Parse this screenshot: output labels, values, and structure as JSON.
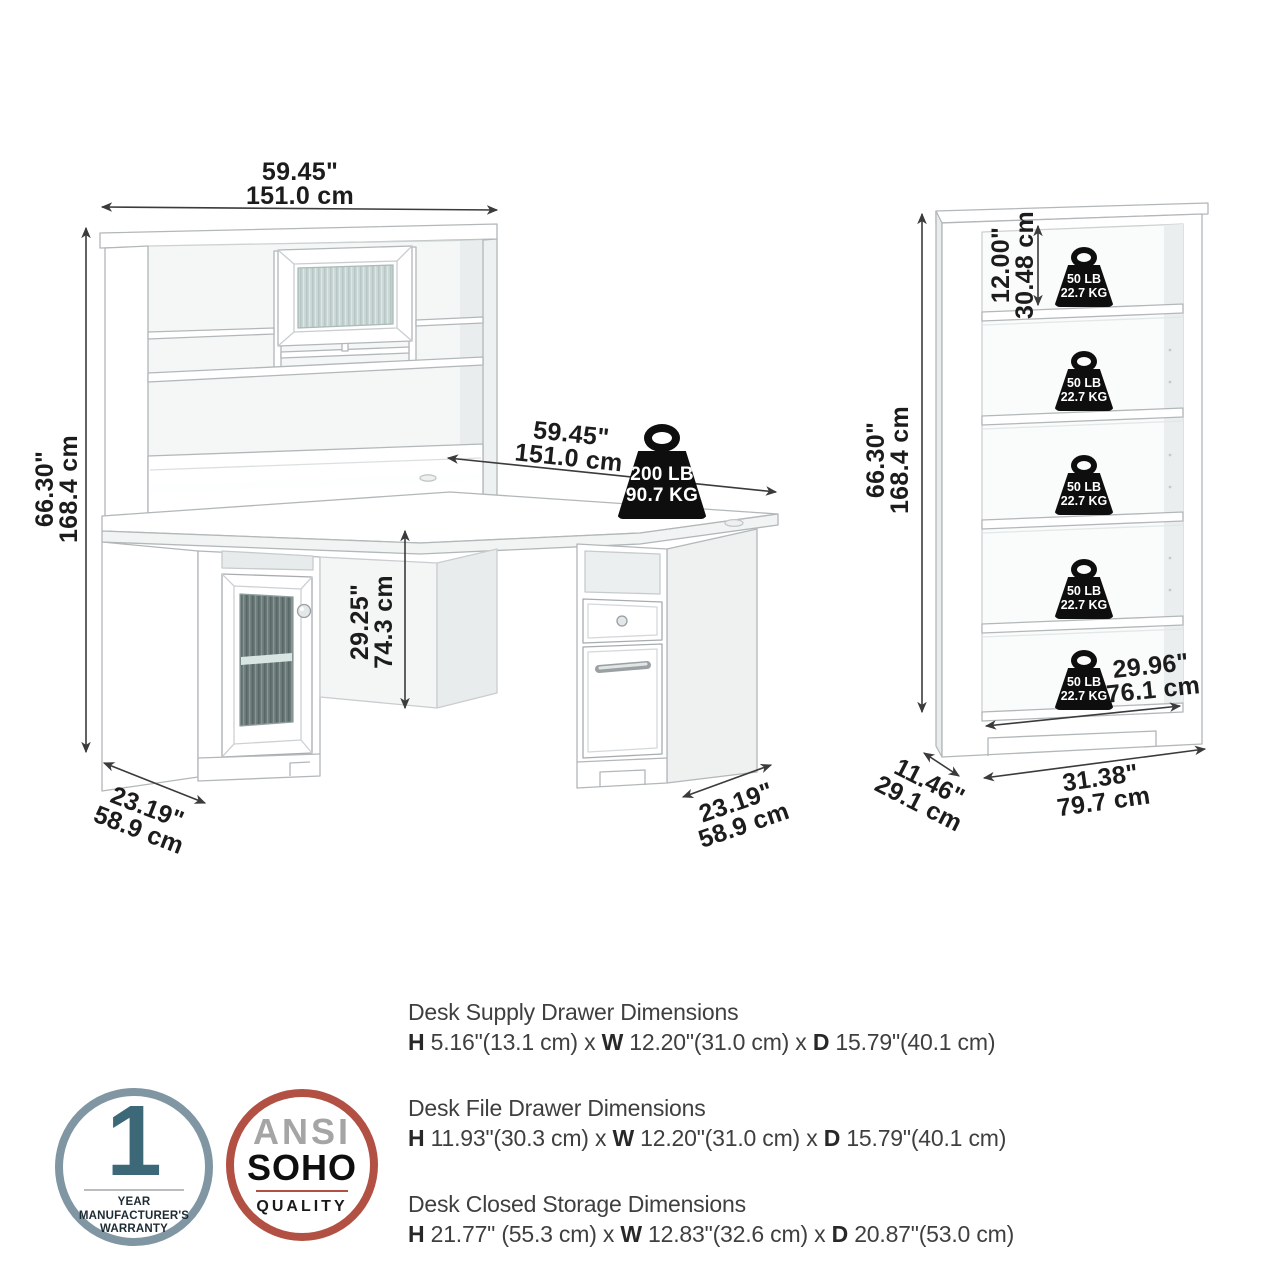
{
  "desk": {
    "hutch_width": {
      "inches": "59.45\"",
      "cm": "151.0 cm"
    },
    "overall_height": {
      "inches": "66.30\"",
      "cm": "168.4 cm"
    },
    "surface_width": {
      "inches": "59.45\"",
      "cm": "151.0 cm"
    },
    "surface_height": {
      "inches": "29.25\"",
      "cm": "74.3 cm"
    },
    "left_depth": {
      "inches": "23.19\"",
      "cm": "58.9 cm"
    },
    "right_depth": {
      "inches": "23.19\"",
      "cm": "58.9 cm"
    },
    "weight_capacity": {
      "lb": "200 LB",
      "kg": "90.7 KG"
    }
  },
  "bookcase": {
    "overall_height": {
      "inches": "66.30\"",
      "cm": "168.4 cm"
    },
    "shelf_spacing": {
      "inches": "12.00\"",
      "cm": "30.48 cm"
    },
    "shelf_width": {
      "inches": "29.96\"",
      "cm": "76.1 cm"
    },
    "depth": {
      "inches": "11.46\"",
      "cm": "29.1 cm"
    },
    "width": {
      "inches": "31.38\"",
      "cm": "79.7 cm"
    },
    "shelf_capacity": {
      "lb": "50 LB",
      "kg": "22.7 KG"
    }
  },
  "specs": [
    {
      "title": "Desk Supply Drawer Dimensions",
      "h_label": "H",
      "h_value": " 5.16\"(13.1 cm) x ",
      "w_label": "W",
      "w_value": " 12.20\"(31.0 cm) x ",
      "d_label": "D",
      "d_value": " 15.79\"(40.1 cm)"
    },
    {
      "title": "Desk File Drawer Dimensions",
      "h_label": "H",
      "h_value": " 11.93\"(30.3 cm) x ",
      "w_label": "W",
      "w_value": " 12.20\"(31.0 cm) x ",
      "d_label": "D",
      "d_value": " 15.79\"(40.1 cm)"
    },
    {
      "title": "Desk Closed Storage Dimensions",
      "h_label": "H",
      "h_value": " 21.77\" (55.3 cm) x ",
      "w_label": "W",
      "w_value": " 12.83\"(32.6 cm) x ",
      "d_label": "D",
      "d_value": " 20.87\"(53.0 cm)"
    }
  ],
  "badges": {
    "warranty": {
      "number": "1",
      "line1": "YEAR MANUFACTURER'S",
      "line2": "WARRANTY"
    },
    "quality": {
      "line1": "ANSI",
      "line2": "SOHO",
      "line3": "QUALITY"
    }
  },
  "icons": {
    "weight_icon": "weight-capacity-icon",
    "arrow_icon": "double-headed-dimension-arrow"
  },
  "colors": {
    "warranty_ring": "#8096a3",
    "warranty_number": "#3d6878",
    "quality_ring": "#b25043",
    "quality_ansi_text": "#a5a5a5",
    "weight_icon_fill": "#0e0e0e",
    "dimension_text": "#1c1c1c"
  }
}
